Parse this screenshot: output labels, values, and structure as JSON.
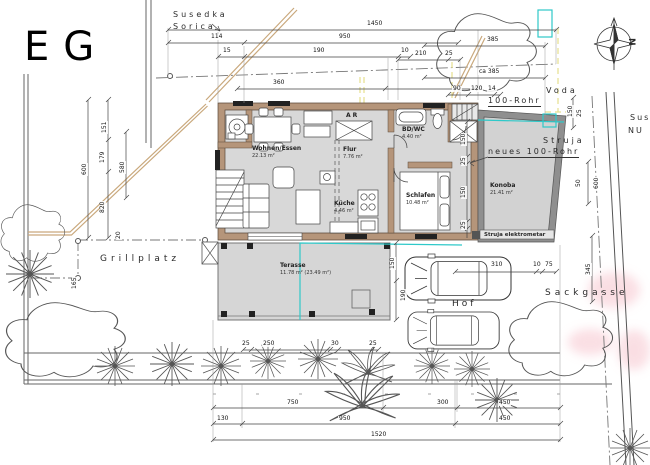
{
  "title": "EG",
  "streets": {
    "top_line1": "Susedka",
    "top_line2": "Sorica",
    "right_line1": "Sus",
    "right_line2": "NU",
    "sackgasse": "Sackgasse"
  },
  "areas": {
    "hof": "Hof",
    "grillplatz": "Grillplatz"
  },
  "utilities": {
    "voda": "Voda",
    "rohr": "100-Rohr",
    "neues_rohr": "neues 100-Rohr",
    "struja": "Struja",
    "elektrometar": "Struja elektrometar"
  },
  "compass": {
    "north": "N"
  },
  "rooms": {
    "wohnen": {
      "name": "Wohnen/Essen",
      "area": "22.13 m²"
    },
    "flur": {
      "name": "Flur",
      "area": "7.76 m²"
    },
    "ar": {
      "name": "AR",
      "area": ""
    },
    "bdwc": {
      "name": "BD/WC",
      "area": "4.40 m²"
    },
    "schlafen": {
      "name": "Schlafen",
      "area": "10.48 m²"
    },
    "kueche": {
      "name": "Küche",
      "area": "4.46 m²"
    },
    "konoba": {
      "name": "Konoba",
      "area": "21.41 m²"
    },
    "terasse": {
      "name": "Terasse",
      "area": "11.78 m² (23.49 m²)"
    }
  },
  "colors": {
    "wall_tan": "#b5957a",
    "room_gray": "#d8d8d8",
    "konoba_wall": "#8f8f8f",
    "highlight_cyan": "#2fc9c9",
    "utility_yellow": "#e6df8e",
    "garden_wall": "#c9a87c",
    "watermark_pink": "#f6bfc9"
  },
  "dims": [
    {
      "t": "1450",
      "x": 366,
      "y": 21
    },
    {
      "t": "950",
      "x": 338,
      "y": 34
    },
    {
      "t": "114",
      "x": 210,
      "y": 34
    },
    {
      "t": "15",
      "x": 222,
      "y": 48
    },
    {
      "t": "190",
      "x": 312,
      "y": 48
    },
    {
      "t": "10",
      "x": 400,
      "y": 48
    },
    {
      "t": "360",
      "x": 272,
      "y": 80
    },
    {
      "t": "385",
      "x": 486,
      "y": 37
    },
    {
      "t": "210",
      "x": 414,
      "y": 51
    },
    {
      "t": "25",
      "x": 444,
      "y": 51
    },
    {
      "t": "ca 385",
      "x": 478,
      "y": 69
    },
    {
      "t": "90",
      "x": 452,
      "y": 86
    },
    {
      "t": "120",
      "x": 470,
      "y": 86
    },
    {
      "t": "14",
      "x": 487,
      "y": 86
    },
    {
      "t": "600",
      "x": 82,
      "y": 176,
      "r": -90
    },
    {
      "t": "151",
      "x": 102,
      "y": 134,
      "r": -90
    },
    {
      "t": "179",
      "x": 100,
      "y": 164,
      "r": -90
    },
    {
      "t": "580",
      "x": 120,
      "y": 174,
      "r": -90
    },
    {
      "t": "820",
      "x": 100,
      "y": 214,
      "r": -90
    },
    {
      "t": "165",
      "x": 72,
      "y": 290,
      "r": -90
    },
    {
      "t": "20",
      "x": 116,
      "y": 240,
      "r": -90
    },
    {
      "t": "150",
      "x": 461,
      "y": 146,
      "r": -90
    },
    {
      "t": "25",
      "x": 461,
      "y": 166,
      "r": -90
    },
    {
      "t": "150",
      "x": 461,
      "y": 199,
      "r": -90
    },
    {
      "t": "25",
      "x": 461,
      "y": 230,
      "r": -90
    },
    {
      "t": "150",
      "x": 568,
      "y": 118,
      "r": -90
    },
    {
      "t": "25",
      "x": 577,
      "y": 118,
      "r": -90
    },
    {
      "t": "50",
      "x": 576,
      "y": 188,
      "r": -90
    },
    {
      "t": "600",
      "x": 594,
      "y": 190,
      "r": -90
    },
    {
      "t": "345",
      "x": 586,
      "y": 276,
      "r": -90
    },
    {
      "t": "150",
      "x": 390,
      "y": 270,
      "r": -90
    },
    {
      "t": "190",
      "x": 401,
      "y": 302,
      "r": -90
    },
    {
      "t": "310",
      "x": 490,
      "y": 262
    },
    {
      "t": "10",
      "x": 532,
      "y": 262
    },
    {
      "t": "75",
      "x": 544,
      "y": 262
    },
    {
      "t": "25",
      "x": 241,
      "y": 341
    },
    {
      "t": "250",
      "x": 262,
      "y": 341
    },
    {
      "t": "30",
      "x": 330,
      "y": 341
    },
    {
      "t": "25",
      "x": 368,
      "y": 341
    },
    {
      "t": "750",
      "x": 286,
      "y": 400
    },
    {
      "t": "300",
      "x": 436,
      "y": 400
    },
    {
      "t": "450",
      "x": 498,
      "y": 400
    },
    {
      "t": "130",
      "x": 216,
      "y": 416
    },
    {
      "t": "950",
      "x": 338,
      "y": 416
    },
    {
      "t": "450",
      "x": 498,
      "y": 416
    },
    {
      "t": "1520",
      "x": 370,
      "y": 432
    }
  ]
}
